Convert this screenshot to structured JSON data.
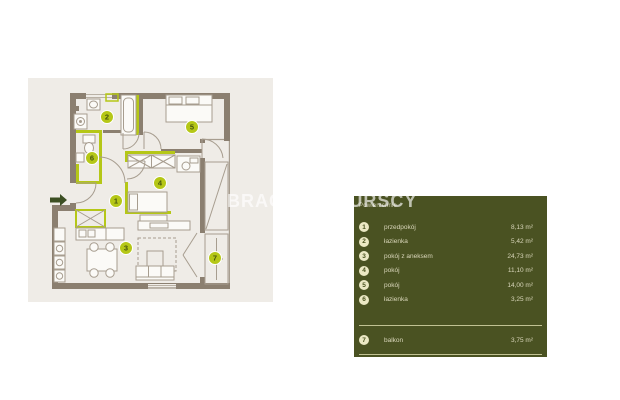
{
  "watermark": "BRACIA SADURSCY",
  "plan": {
    "rooms": [
      {
        "num": "1"
      },
      {
        "num": "2"
      },
      {
        "num": "3"
      },
      {
        "num": "4"
      },
      {
        "num": "5"
      },
      {
        "num": "6"
      },
      {
        "num": "7"
      }
    ]
  },
  "legend": {
    "title": "Powierzchnie",
    "rows": [
      {
        "num": "1",
        "label": "przedpokój",
        "area": "8,13 m²"
      },
      {
        "num": "2",
        "label": "łazienka",
        "area": "5,42 m²"
      },
      {
        "num": "3",
        "label": "pokój z aneksem",
        "area": "24,73 m²"
      },
      {
        "num": "4",
        "label": "pokój",
        "area": "11,10 m²"
      },
      {
        "num": "5",
        "label": "pokój",
        "area": "14,00 m²"
      },
      {
        "num": "6",
        "label": "łazienka",
        "area": "3,25 m²"
      }
    ],
    "footer_row": {
      "num": "7",
      "label": "balkon",
      "area": "3,75 m²"
    }
  },
  "colors": {
    "accent_lime": "#b5c717",
    "panel_bg": "#4a5222",
    "wall_taupe": "#8b7f70",
    "plan_bg": "#efece7",
    "arrow_dark_green": "#3c4f23",
    "legend_circle_bg": "#ebe8c4",
    "legend_text": "#d9d6ba"
  }
}
